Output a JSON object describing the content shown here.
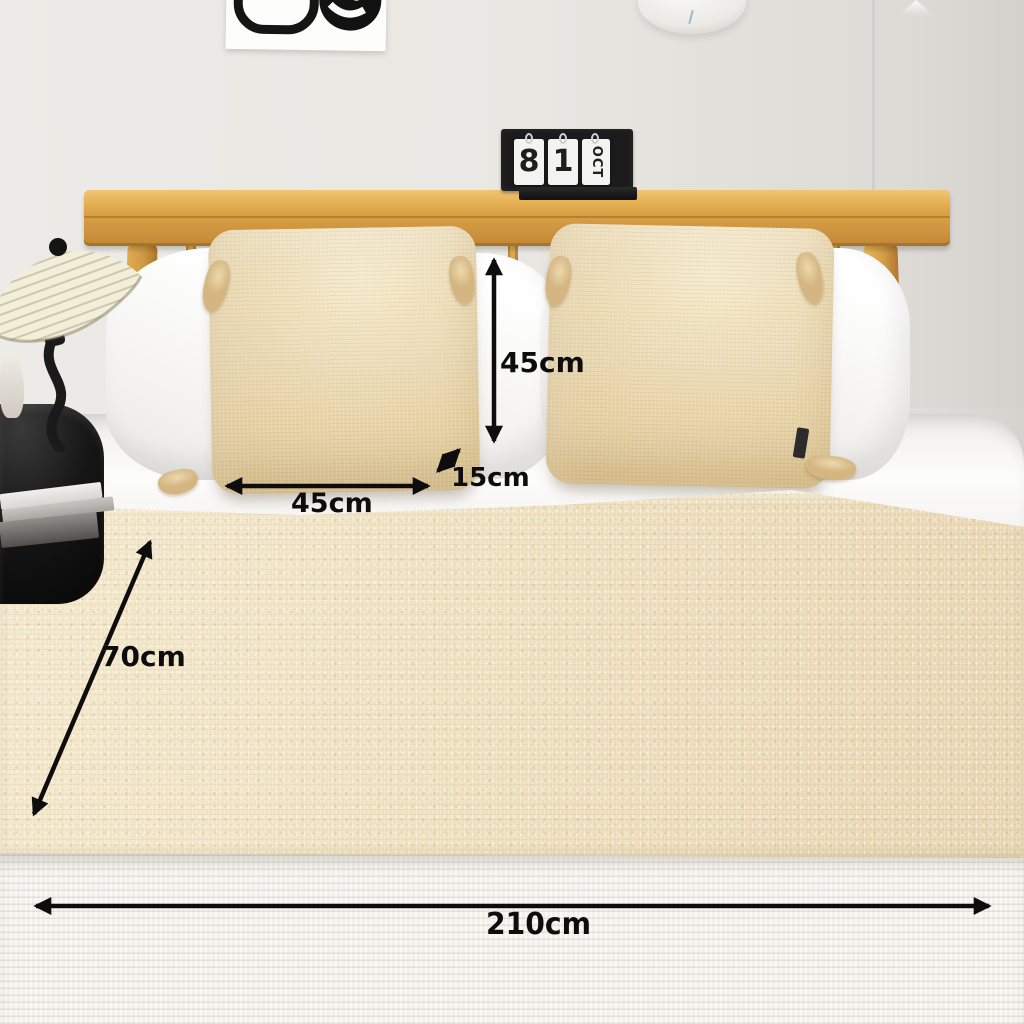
{
  "scene": {
    "description": "Bedroom product photo: wooden bed with two beige tassel cushions and a cream bed runner, annotated with size arrows"
  },
  "dimension_labels": {
    "cushion_height": "45cm",
    "cushion_depth": "15cm",
    "cushion_width": "45cm",
    "runner_width": "70cm",
    "runner_length": "210cm"
  },
  "flip_calendar": {
    "day_tens": "8",
    "day_units": "1",
    "month": "OCT"
  },
  "colors": {
    "wood_frame": "#d29a41",
    "cushion_beige": "#e9d6a9",
    "runner_cream": "#efe1bf",
    "white_bedding": "#fbfbfa",
    "annotation": "#0d0d0d"
  }
}
